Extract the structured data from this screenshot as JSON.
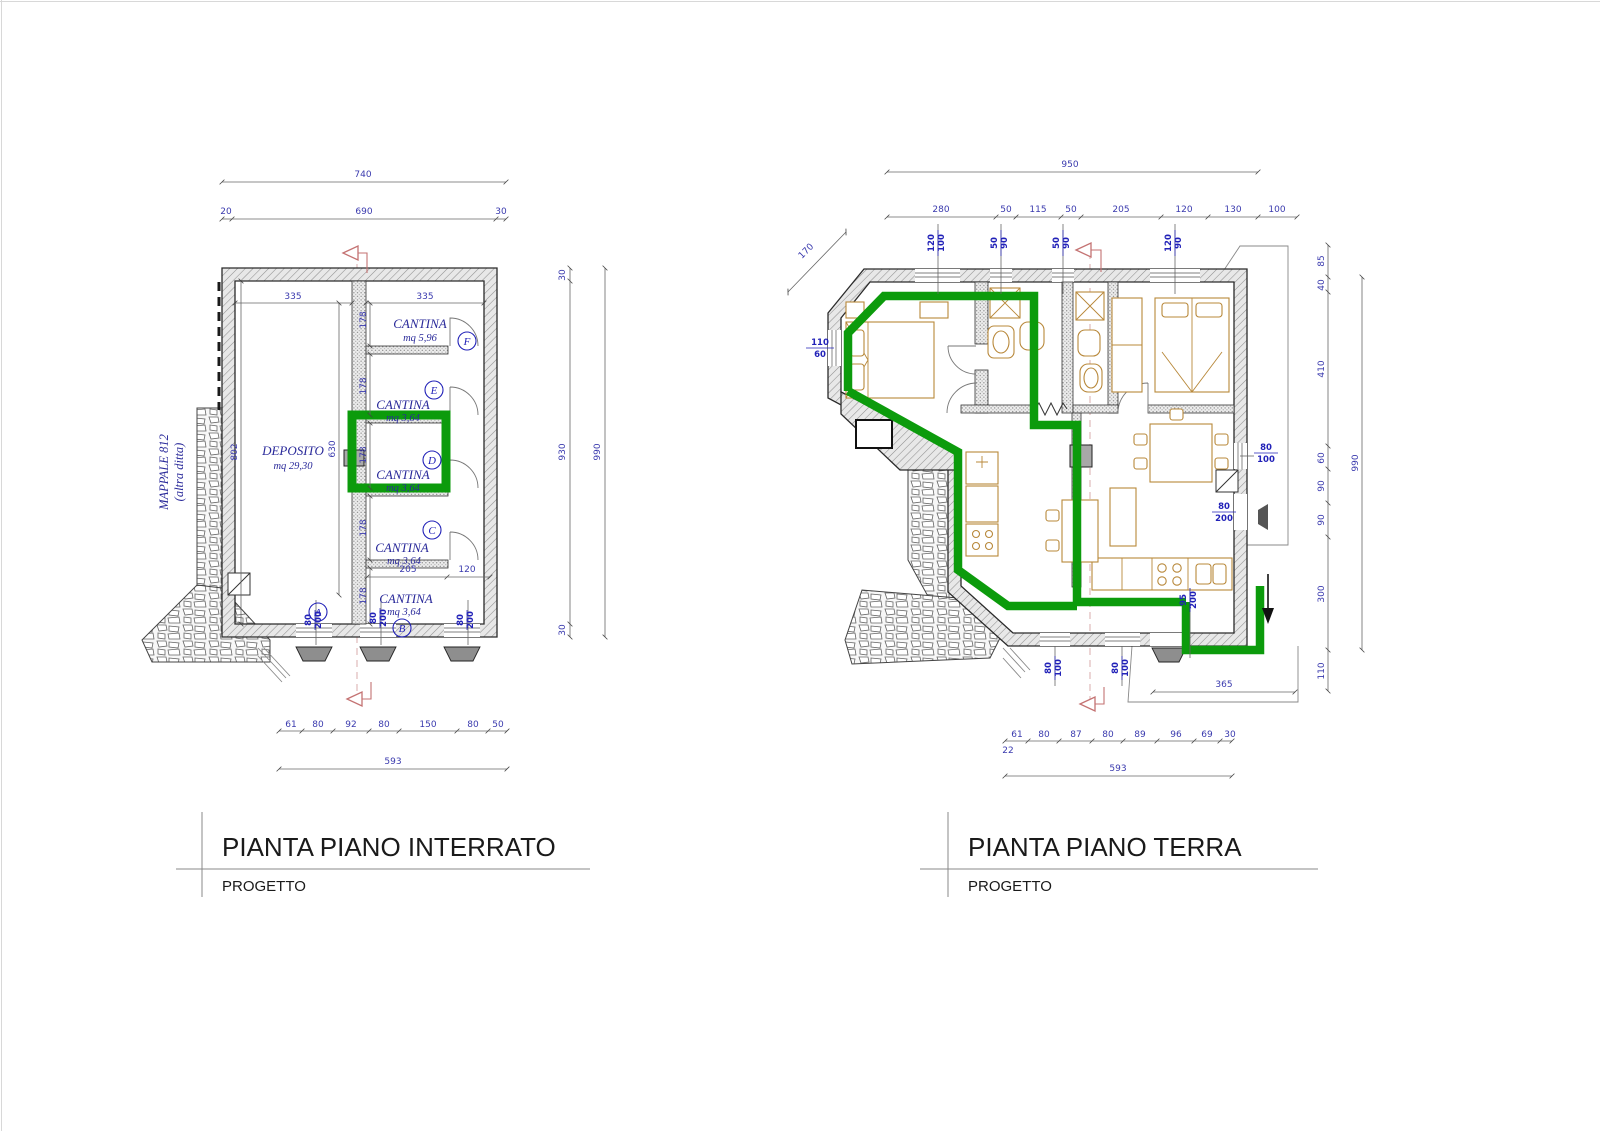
{
  "document": {
    "left_panel": {
      "title": "PIANTA PIANO INTERRATO",
      "subtitle": "PROGETTO"
    },
    "right_panel": {
      "title": "PIANTA PIANO TERRA",
      "subtitle": "PROGETTO"
    },
    "colors": {
      "highlight": "#0c9b0c",
      "dim_text": "#3a3aae",
      "label_blue": "#2222b8",
      "section_red": "#c47272",
      "furniture": "#b8883a"
    },
    "left_plan": {
      "parcel": {
        "line1": "MAPPALE 812",
        "line2": "(altra ditta)"
      },
      "rooms": {
        "deposito": {
          "name": "DEPOSITO",
          "area": "mq 29,30"
        },
        "f": {
          "name": "CANTINA",
          "area": "mq 5,96"
        },
        "e": {
          "name": "CANTINA",
          "area": "mq 3,64"
        },
        "d": {
          "name": "CANTINA",
          "area": "mq 3,64"
        },
        "c": {
          "name": "CANTINA",
          "area": "mq 3,64"
        },
        "b": {
          "name": "CANTINA",
          "area": "mq 3,64"
        }
      },
      "marks": {
        "a": "A",
        "b": "B",
        "c": "C",
        "d": "D",
        "e": "E",
        "f": "F"
      },
      "door_sizes": [
        {
          "w": "80",
          "h": "200"
        },
        {
          "w": "80",
          "h": "200"
        },
        {
          "w": "80",
          "h": "200"
        }
      ],
      "dims": {
        "top_total": "740",
        "top_chain": [
          "20",
          "690",
          "30"
        ],
        "side_chain": [
          "30",
          "930",
          "30"
        ],
        "side_total": "990",
        "w335l": "335",
        "w335r": "335",
        "h178": [
          "178",
          "178",
          "178",
          "178",
          "178"
        ],
        "h802": "802",
        "h630": "630",
        "w205": "205",
        "w120": "120",
        "bottom_chain": [
          "61",
          "80",
          "92",
          "80",
          "150",
          "80",
          "50"
        ],
        "bottom_total": "593"
      }
    },
    "right_plan": {
      "dims": {
        "top_total": "950",
        "top_chain": [
          "280",
          "50",
          "115",
          "50",
          "205",
          "120",
          "130",
          "100"
        ],
        "diag": "170",
        "side_chain": [
          "85",
          "40",
          "410",
          "60",
          "90",
          "90",
          "300",
          "110"
        ],
        "side_total": "990",
        "w365": "365",
        "bottom_chain": [
          "61",
          "80",
          "87",
          "80",
          "89",
          "96",
          "69",
          "30"
        ],
        "bottom_offset": "22",
        "bottom_total": "593"
      },
      "openings": {
        "top": [
          {
            "w": "120",
            "h": "100"
          },
          {
            "w": "50",
            "h": "90"
          },
          {
            "w": "50",
            "h": "90"
          },
          {
            "w": "120",
            "h": "90"
          }
        ],
        "left": {
          "w": "110",
          "h": "60"
        },
        "right_window": {
          "w": "80",
          "h": "100"
        },
        "right_door": {
          "w": "80",
          "h": "200"
        },
        "bottom": [
          {
            "w": "80",
            "h": "100"
          },
          {
            "w": "80",
            "h": "100"
          }
        ],
        "entry": {
          "w": "95",
          "h": "200"
        }
      }
    }
  }
}
